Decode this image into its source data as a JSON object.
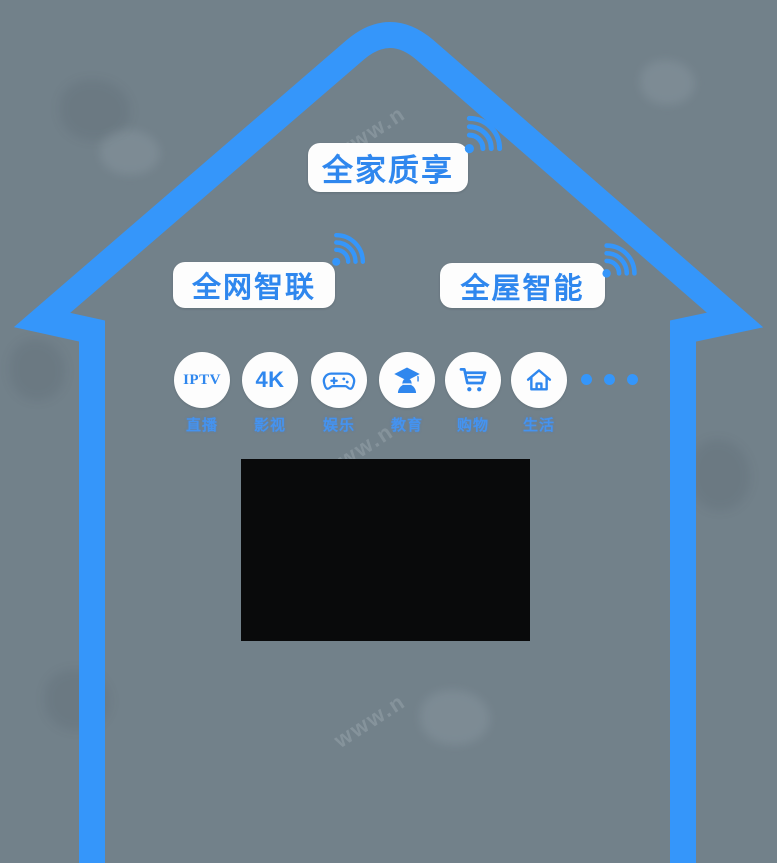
{
  "poster": {
    "banners": {
      "top": {
        "label": "全家质享"
      },
      "left": {
        "label": "全网智联"
      },
      "right": {
        "label": "全屋智能"
      }
    },
    "services": [
      {
        "name": "iptv",
        "icon": "iptv-badge",
        "badge_text": "IPTV",
        "label": "直播"
      },
      {
        "name": "uhd-4k",
        "icon": "4k-badge",
        "badge_text": "4K",
        "label": "影视"
      },
      {
        "name": "entertainment",
        "icon": "gamepad-icon",
        "badge_text": "",
        "label": "娱乐"
      },
      {
        "name": "education",
        "icon": "graduate-icon",
        "badge_text": "",
        "label": "教育"
      },
      {
        "name": "shopping",
        "icon": "cart-icon",
        "badge_text": "",
        "label": "购物"
      },
      {
        "name": "life",
        "icon": "home-icon",
        "badge_text": "",
        "label": "生活"
      }
    ],
    "more_indicator": "dots-x3",
    "watermark_fragment": "www.n",
    "colors": {
      "background": "#72818a",
      "house_outline": "#3596fa",
      "accent_text": "#2f87ee",
      "banner_background": "#fdfdfd",
      "screen": "#090a0b"
    }
  }
}
